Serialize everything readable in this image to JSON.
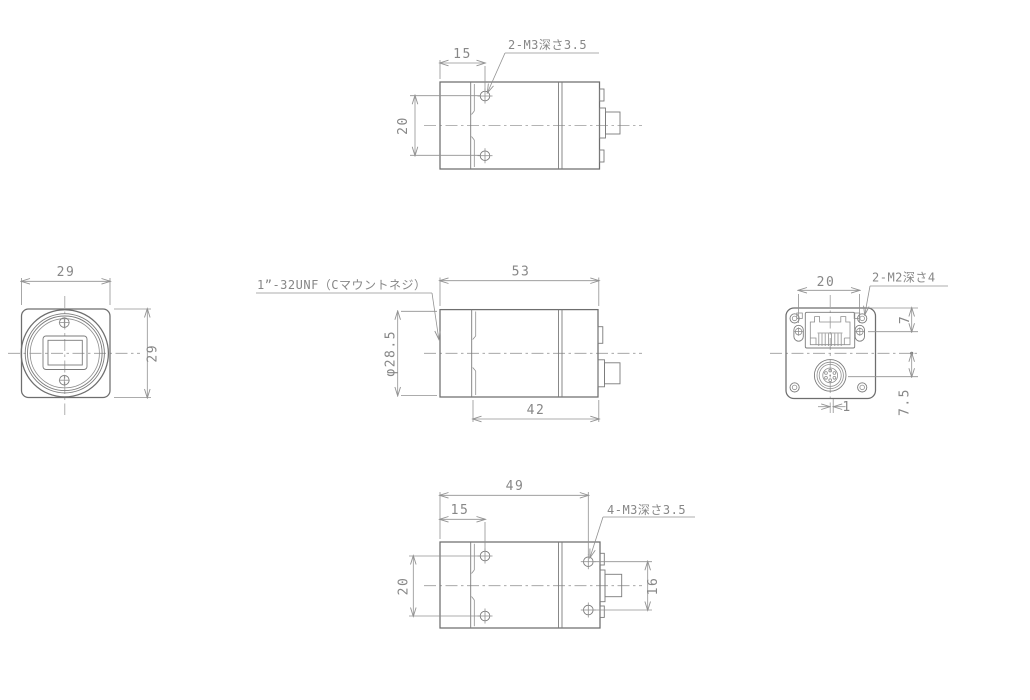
{
  "drawing": {
    "type": "mechanical-dimension-drawing",
    "subject": "industrial camera outline drawing, 5 orthographic views",
    "units": "mm",
    "line_color": "#6e6e6e",
    "dim_color": "#919191",
    "background": "#ffffff"
  },
  "views": {
    "top": {
      "name": "top view",
      "d15": "15",
      "d20": "20",
      "label": "2-M3深さ3.5"
    },
    "front": {
      "name": "front view (lens side)",
      "d29w": "29",
      "d29h": "29"
    },
    "side": {
      "name": "side view",
      "d53": "53",
      "d42": "42",
      "dia": "φ28.5",
      "label": "1”-32UNF（Cマウントネジ）"
    },
    "rear": {
      "name": "rear view (connector side)",
      "d20": "20",
      "d7": "7",
      "d7_5": "7.5",
      "d1": "1",
      "label": "2-M2深さ4"
    },
    "bottom": {
      "name": "bottom view",
      "d49": "49",
      "d15": "15",
      "d20": "20",
      "d16": "16",
      "label": "4-M3深さ3.5"
    }
  }
}
